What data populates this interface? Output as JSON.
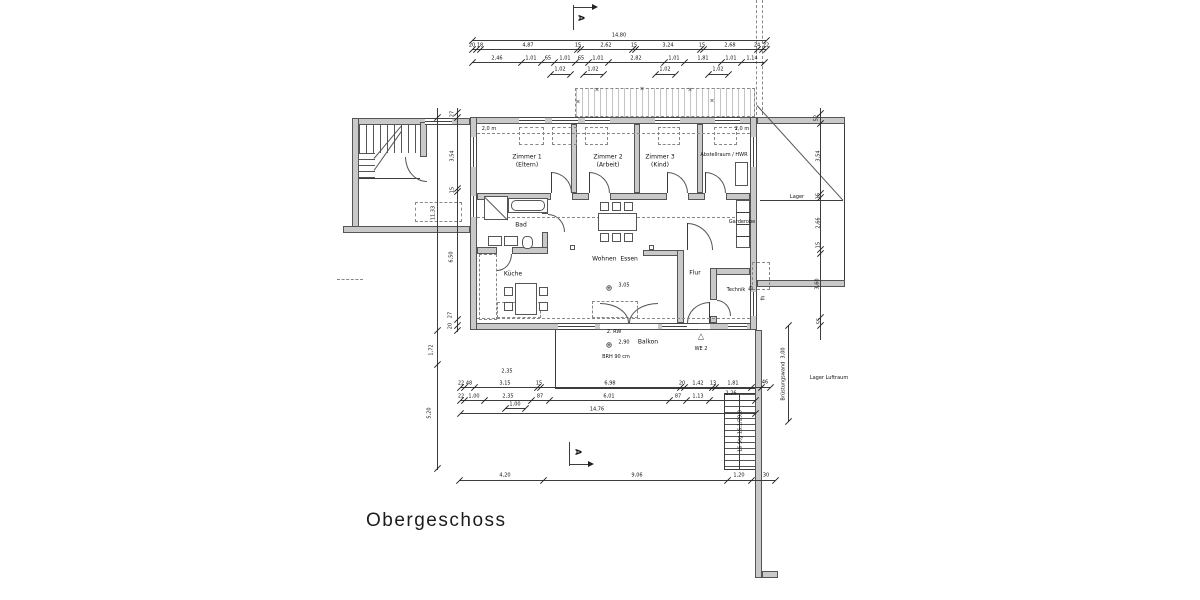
{
  "title": "Obergeschoss",
  "section_marker": "A",
  "icons": {
    "level_marker": "⊕",
    "apartment_triangle": "△",
    "roof_mark": "×"
  },
  "rooms": {
    "zimmer1": {
      "name": "Zimmer 1",
      "sub": "(Eltern)"
    },
    "zimmer2": {
      "name": "Zimmer 2",
      "sub": "(Arbeit)"
    },
    "zimmer3": {
      "name": "Zimmer 3",
      "sub": "(Kind)"
    },
    "abstellraum": {
      "name": "Abstellraum / HWR"
    },
    "bad": {
      "name": "Bad"
    },
    "kueche": {
      "name": "Küche"
    },
    "wohnen": {
      "name": "Wohnen  Essen"
    },
    "flur": {
      "name": "Flur"
    },
    "technik": {
      "name": "Technik"
    },
    "garderobe": {
      "name": "Garderobe"
    },
    "lager": {
      "name": "Lager"
    },
    "lager_luftraum": {
      "name": "Lager Luftraum"
    },
    "balkon": {
      "name": "Balkon"
    }
  },
  "annotations": {
    "height_line_left": "2,0 m",
    "height_line_right": "2,0 m",
    "second_escape": "2. RW",
    "parapet": "BRH 90 cm",
    "unit": "WE 2",
    "level_main": "3,05",
    "level_balcony": "2,90",
    "stair_note": "16 Stg 16,1/29,0",
    "wall_note": "Brüstungswand  3,00",
    "fh1": "fh",
    "fh2": "fh"
  },
  "dims": {
    "top_total": "14,80",
    "top_row2": [
      "20",
      "18",
      "4,87",
      "15",
      "2,62",
      "15",
      "3,24",
      "15",
      "2,68",
      "24",
      "22"
    ],
    "top_row3": [
      "2,46",
      "1,01",
      "65",
      "1,01",
      "65",
      "1,01",
      "2,82",
      "1,01",
      "1,81",
      "1,01",
      "1,14"
    ],
    "top_row4": [
      "1,02",
      "1,02",
      "1,02",
      "1,02"
    ],
    "bottom_row1": [
      "22",
      "48",
      "3,15",
      "15",
      "6,98",
      "20",
      "1,42",
      "13",
      "1,81",
      "46"
    ],
    "bottom_row2": [
      "22",
      "1,00",
      "2,35",
      "87",
      "6,01",
      "87",
      "1,13",
      "2,26"
    ],
    "bottom_sub": "1,00",
    "bottom_total": "14,76",
    "bottom_note": "2,35",
    "bottom_outer": [
      "4,20",
      "9,06",
      "1,20",
      "30"
    ],
    "left_inner": [
      "27",
      "3,54",
      "15",
      "6,50",
      "27",
      "20"
    ],
    "left_outer": [
      "11,33",
      "1,72",
      "5,20"
    ],
    "right_inner": [
      "52",
      "3,54",
      "15",
      "2,66",
      "15",
      "3,60",
      "55"
    ]
  }
}
